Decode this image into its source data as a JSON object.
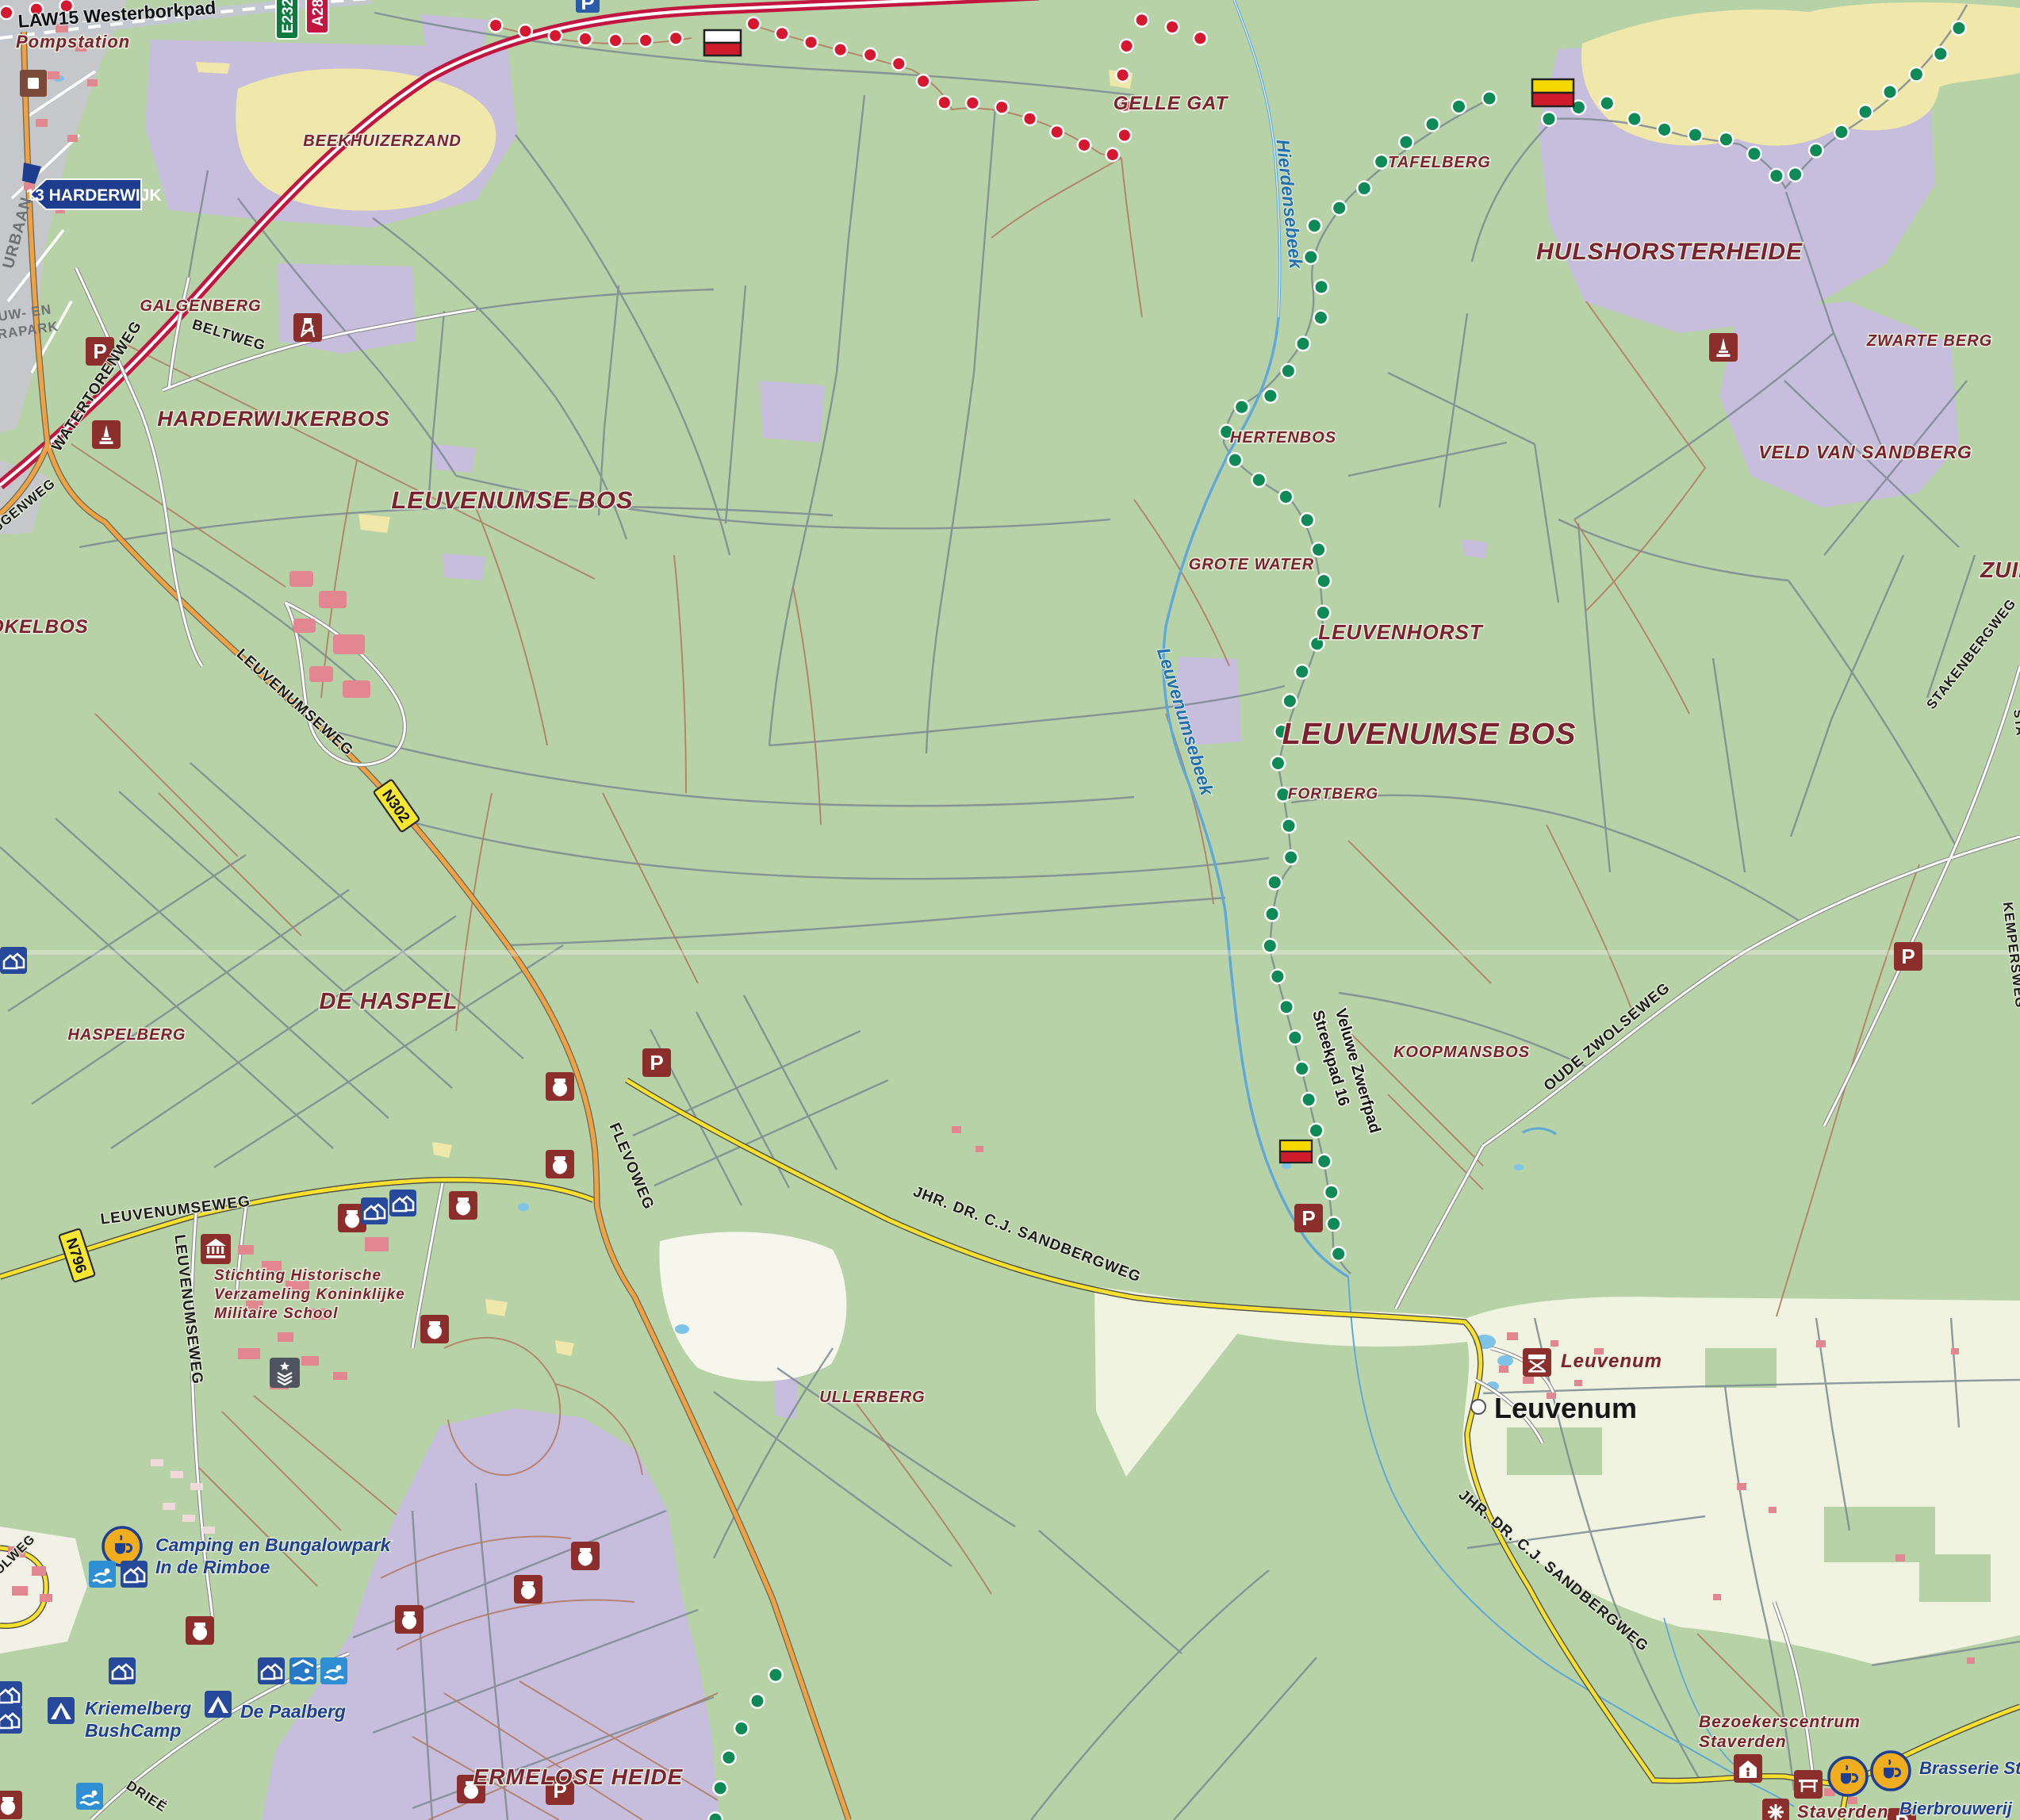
{
  "title": "Topographic hiking map - Leuvenumse Bos / Veluwe",
  "colors": {
    "forest": "#b7d2a6",
    "heath": "#c7bedd",
    "sand": "#f0e8ab",
    "farmland": "#eff3e0",
    "open_sand": "#f6f6ec",
    "urban": "#c6c7cb",
    "water": "#5fa8d8",
    "motorway": "#c2153f",
    "main_road": "#f0a243",
    "secondary_road": "#f8e12e",
    "minor_road": "#ffffff",
    "track": "#7d8a93",
    "path": "#b27b63",
    "trail_red": "#d5182f",
    "trail_green": "#0d8a55",
    "label_maroon": "#7a2230",
    "label_blue": "#1d3f94",
    "icon_red": "#8c2f2c",
    "icon_blue": "#27499c",
    "icon_lightblue": "#2e8fd5",
    "cafe_yellow": "#f0ad1d"
  },
  "labels": {
    "trail": {
      "law15": "LAW15 Westerborkpad",
      "streekpad": "Streekpad 16",
      "zwerfpad": "Veluwe Zwerfpad"
    },
    "region": {
      "beekhuizerzand": "BEEKHUIZERZAND",
      "galgenberg": "GALGENBERG",
      "harderwijkerbos": "HARDERWIJKERBOS",
      "gelle_gat": "GELLE GAT",
      "tafelberg": "TAFELBERG",
      "hulshorsterheide": "HULSHORSTERHEIDE",
      "zwarte_berg": "ZWARTE BERG",
      "veld_van_sandberg": "VELD VAN SANDBERG",
      "zuid": "ZUID",
      "hertenbos": "HERTENBOS",
      "grote_water": "GROTE WATER",
      "leuvenhorst": "LEUVENHORST",
      "leuvenumse_bos_1": "LEUVENUMSE BOS",
      "leuvenumse_bos_2": "LEUVENUMSE BOS",
      "fortberg": "FORTBERG",
      "okelbos": "OKELBOS",
      "de_haspel": "DE HASPEL",
      "haspelberg": "HASPELBERG",
      "koopmansbos": "KOOPMANSBOS",
      "ullerberg": "ULLERBERG",
      "ermelose_heide": "ERMELOSE HEIDE"
    },
    "road": {
      "beltweg": "BELTWEG",
      "watertorenweg": "WATERTORENWEG",
      "leuvenumseweg_1": "LEUVENUMSEWEG",
      "leuvenumseweg_2": "LEUVENUMSEWEG",
      "leuvenumseweg_3": "LEUVENUMSEWEG",
      "flevoweg": "FLEVOWEG",
      "sandbergweg_1": "JHR. DR. C.J. SANDBERGWEG",
      "sandbergweg_2": "JHR. DR. C.J. SANDBERGWEG",
      "oude_zwolseweg": "OUDE ZWOLSEWEG",
      "stakenbergweg": "STAKENBERGWEG",
      "kempersweg": "KEMPERSWEG",
      "urbaan": "URBAAN",
      "ggenweg": "GGENWEG",
      "olweg": "OLWEG",
      "drieerweg": "DRIEË",
      "sta": "STA"
    },
    "water": {
      "hierdensebeek": "Hierdensebeek",
      "leuvenumsebeek": "Leuvenumsebeek"
    },
    "place": {
      "pompstation": "Pompstation",
      "leuvenum_estate": "Leuvenum",
      "leuvenum": "Leuvenum",
      "staverden": "Staverden",
      "urban_1": "UW- EN",
      "urban_2": "RAPARK"
    },
    "poi": {
      "stichting_1": "Stichting Historische",
      "stichting_2": "Verzameling Koninklijke",
      "stichting_3": "Militaire School",
      "rimboe_1": "Camping en Bungalowpark",
      "rimboe_2": "In de Rimboe",
      "kriemelberg_1": "Kriemelberg",
      "kriemelberg_2": "BushCamp",
      "de_paalberg": "De Paalberg",
      "bezoekerscentrum_1": "Bezoekerscentrum",
      "bezoekerscentrum_2": "Staverden",
      "brasserie": "Brasserie Sta",
      "bierbrouwerij": "Bierbrouwerij"
    },
    "shields": {
      "a28": "A28",
      "e232": "E232",
      "n302": "N302",
      "n796": "N796",
      "parking": "P"
    },
    "signs": {
      "exit": "13 HARDERWIJK"
    }
  }
}
